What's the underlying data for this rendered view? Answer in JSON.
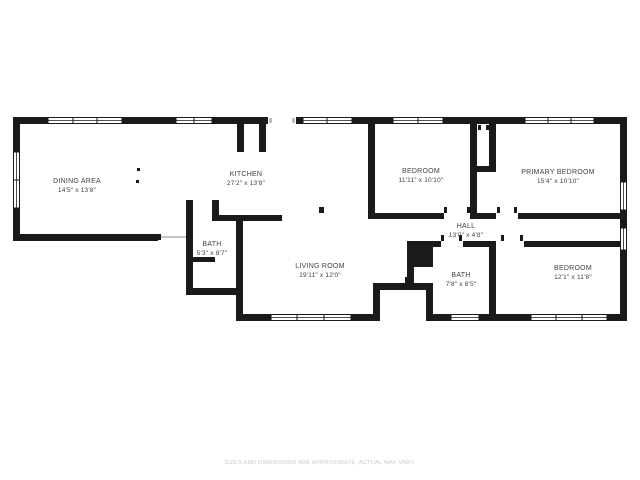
{
  "floor_plan": {
    "rooms": [
      {
        "name": "DINING AREA",
        "dims": "14'5\" x 13'8\""
      },
      {
        "name": "KITCHEN",
        "dims": "27'2\" x 13'8\""
      },
      {
        "name": "BEDROOM",
        "dims": "11'11\" x 10'10\""
      },
      {
        "name": "PRIMARY BEDROOM",
        "dims": "15'4\" x 10'10\""
      },
      {
        "name": "HALL",
        "dims": "13'0\" x 4'8\""
      },
      {
        "name": "BATH",
        "dims": "5'3\" x 8'7\""
      },
      {
        "name": "LIVING ROOM",
        "dims": "19'11\" x 12'0\""
      },
      {
        "name": "BATH",
        "dims": "7'8\" x 8'5\""
      },
      {
        "name": "BEDROOM",
        "dims": "12'1\" x 11'8\""
      }
    ],
    "disclaimer": "SIZES AND DIMENSIONS ARE APPROXIMATE, ACTUAL MAY VARY.",
    "colors": {
      "wall": "#1a1a1a",
      "label_text": "#414141",
      "disclaimer_text": "#c9c9c9",
      "background": "#ffffff"
    }
  }
}
